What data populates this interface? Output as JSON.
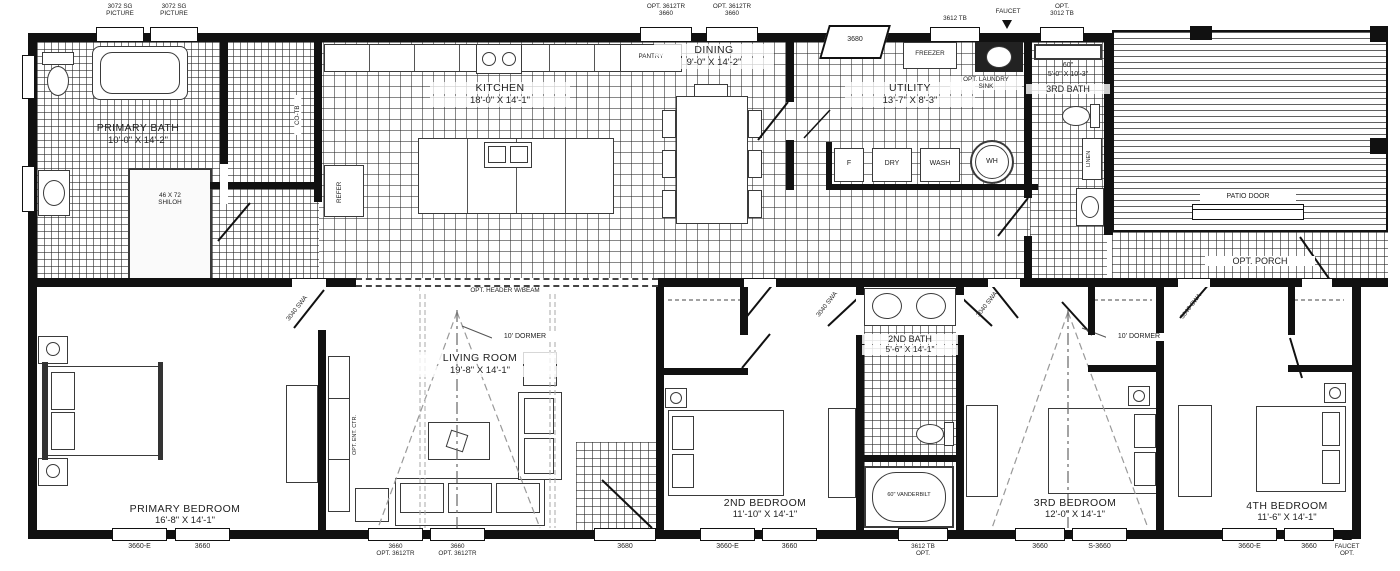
{
  "rooms": {
    "primary_bath": {
      "name": "PRIMARY BATH",
      "dims": "10'-0\" X 14'-2\""
    },
    "kitchen": {
      "name": "KITCHEN",
      "dims": "18'-0\" X 14'-1\""
    },
    "dining": {
      "name": "DINING",
      "dims": "9'-0\" X 14'-2\""
    },
    "utility": {
      "name": "UTILITY",
      "dims": "13'-7\" X 8'-3\""
    },
    "third_bath": {
      "name": "3RD BATH",
      "shower_size": "60\"",
      "shower_dims": "5'-0\" X 10'-3\""
    },
    "primary_bedroom": {
      "name": "PRIMARY BEDROOM",
      "dims": "16'-8\" X 14'-1\""
    },
    "living_room": {
      "name": "LIVING ROOM",
      "dims": "19'-8\" X 14'-1\""
    },
    "second_bedroom": {
      "name": "2ND BEDROOM",
      "dims": "11'-10\" X 14'-1\""
    },
    "second_bath": {
      "name": "2ND BATH",
      "dims": "5'-6\" X 14'-1\""
    },
    "third_bedroom": {
      "name": "3RD BEDROOM",
      "dims": "12'-0\" X 14'-1\""
    },
    "fourth_bedroom": {
      "name": "4TH BEDROOM",
      "dims": "11'-6\" X 14'-1\""
    }
  },
  "fixtures": {
    "shiloh_shower": "46 X 72\nSHILOH",
    "freezer": "FREEZER",
    "dryer": "DRY",
    "washer": "WASH",
    "water_heater": "WH",
    "furnace": "F",
    "refrigerator": "REFER",
    "pantry": "PANTRY",
    "closet_co_tb": "CO-TB",
    "linen": "LINEN",
    "tub_vanderbilt": "60\" VANDERBILT",
    "opt_laundry_sink": "OPT. LAUNDRY\nSINK",
    "opt_ent_center": "OPT. ENT. CTR."
  },
  "annotations": {
    "patio_door": "PATIO DOOR",
    "opt_porch": "OPT. PORCH",
    "dormer_living": "10' DORMER",
    "dormer_third": "10' DORMER",
    "opt_header": "OPT. HEADER W/BEAM",
    "faucet": "FAUCET",
    "faucet_opt": "FAUCET\nOPT.",
    "door_swing": "3040 SWA"
  },
  "top_openings": {
    "picture_1": "3072 SG\nPICTURE",
    "picture_2": "3072 SG\nPICTURE",
    "dining_win_1": "OPT. 3612TR\n3660",
    "dining_win_2": "OPT. 3612TR\n3660",
    "entry_door": "3680",
    "utility_win": "3612 TB",
    "bath3_win": "OPT.\n3012 TB"
  },
  "bottom_openings": {
    "pbr_win_1": "3660-E",
    "pbr_win_2": "3660",
    "lr_win_1": "3660\nOPT. 3612TR",
    "lr_win_2": "3660\nOPT. 3612TR",
    "entry_door": "3680",
    "br2_win_1": "3660-E",
    "br2_win_2": "3660",
    "bath2_win": "3612 TB\nOPT.",
    "br3_win_1": "3660",
    "br3_win_2": "S-3660",
    "br4_win_1": "3660-E",
    "br4_win_2": "3660"
  }
}
